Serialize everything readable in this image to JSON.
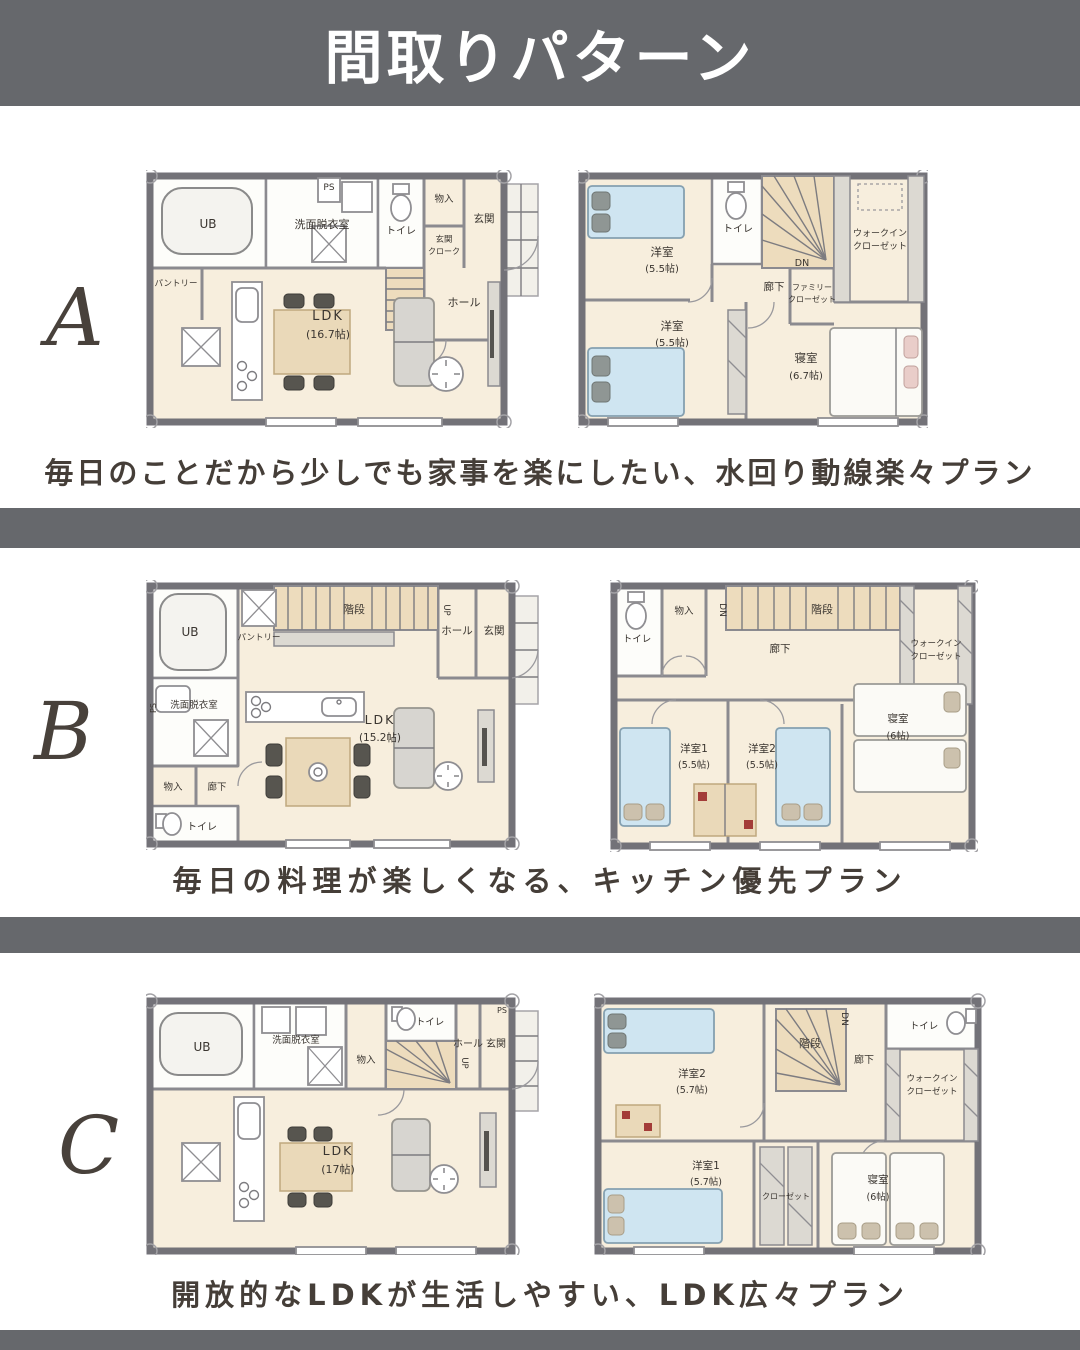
{
  "page": {
    "title": "間取りパターン",
    "colors": {
      "band": "#66686c",
      "caption_text": "#453e38",
      "letter_text": "#48413b",
      "floor_cream": "#f7eedd",
      "bed_blue": "#cfe5f1",
      "stair_tan": "#eddcbd"
    }
  },
  "sections": {
    "a": {
      "letter": "A",
      "caption": "毎日のことだから少しでも家事を楽にしたい、水回り動線楽々プラン",
      "f1": {
        "ub": "UB",
        "senmen": "洗面脱衣室",
        "toilet": "トイレ",
        "ps": "PS",
        "monoire": "物入",
        "cloak1": "玄関",
        "cloak2": "クローク",
        "genkan": "玄関",
        "hall": "ホール",
        "pantry": "パントリー",
        "ldk": "LDK",
        "ldk_size": "(16.7帖)"
      },
      "f2": {
        "yoshitsu1": "洋室",
        "yoshitsu1_size": "(5.5帖)",
        "toilet": "トイレ",
        "dn": "DN",
        "rouka": "廊下",
        "family1": "ファミリー",
        "family2": "クローゼット",
        "wic1": "ウォークイン",
        "wic2": "クローゼット",
        "yoshitsu2": "洋室",
        "yoshitsu2_size": "(5.5帖)",
        "shinshitsu": "寝室",
        "shinshitsu_size": "(6.7帖)"
      }
    },
    "b": {
      "letter": "B",
      "caption": "毎日の料理が楽しくなる、キッチン優先プラン",
      "f1": {
        "ub": "UB",
        "pantry": "パントリー",
        "kaidan": "階段",
        "up": "UP",
        "hall": "ホール",
        "genkan": "玄関",
        "ps": "PS",
        "senmen": "洗面脱衣室",
        "monoire": "物入",
        "rouka": "廊下",
        "toilet": "トイレ",
        "ldk": "LDK",
        "ldk_size": "(15.2帖)"
      },
      "f2": {
        "toilet": "トイレ",
        "monoire": "物入",
        "dn": "DN",
        "kaidan": "階段",
        "wic1": "ウォークイン",
        "wic2": "クローゼット",
        "rouka": "廊下",
        "yoshitsu1": "洋室1",
        "yoshitsu1_size": "(5.5帖)",
        "yoshitsu2": "洋室2",
        "yoshitsu2_size": "(5.5帖)",
        "shinshitsu": "寝室",
        "shinshitsu_size": "(6帖)"
      }
    },
    "c": {
      "letter": "C",
      "caption": "開放的なLDKが生活しやすい、LDK広々プラン",
      "f1": {
        "ub": "UB",
        "senmen": "洗面脱衣室",
        "monoire": "物入",
        "toilet": "トイレ",
        "up": "UP",
        "hall": "ホール",
        "genkan": "玄関",
        "ps": "PS",
        "ldk": "LDK",
        "ldk_size": "(17帖)"
      },
      "f2": {
        "yoshitsu2": "洋室2",
        "yoshitsu2_size": "(5.7帖)",
        "kaidan": "階段",
        "dn": "DN",
        "toilet": "トイレ",
        "rouka": "廊下",
        "wic1": "ウォークイン",
        "wic2": "クローゼット",
        "yoshitsu1": "洋室1",
        "yoshitsu1_size": "(5.7帖)",
        "closet": "クローゼット",
        "shinshitsu": "寝室",
        "shinshitsu_size": "(6帖)"
      }
    }
  }
}
